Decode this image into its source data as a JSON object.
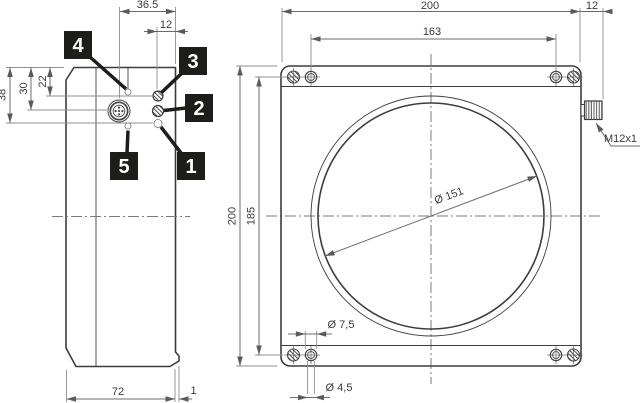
{
  "drawing": {
    "side_view": {
      "dim_connector_to_front": "36.5",
      "dim_led_to_front": "12",
      "dim_38": "38",
      "dim_30": "30",
      "dim_22": "22",
      "dim_depth": "72",
      "dim_lip": "1",
      "callouts": {
        "c1": "1",
        "c2": "2",
        "c3": "3",
        "c4": "4",
        "c5": "5"
      }
    },
    "front_view": {
      "dim_width": "200",
      "dim_hole_spacing_h": "163",
      "dim_connector_length": "12",
      "dim_height": "200",
      "dim_hole_spacing_v": "185",
      "dim_lens_diameter": "Ø 151",
      "dim_counterbore": "Ø 7,5",
      "dim_through_hole": "Ø 4,5",
      "connector_thread": "M12x1"
    },
    "colors": {
      "line": "#3d3d3d",
      "dim_line": "#6b6b6b",
      "callout_bg": "#1d1d1b",
      "callout_fg": "#ffffff",
      "background": "#ffffff"
    }
  }
}
